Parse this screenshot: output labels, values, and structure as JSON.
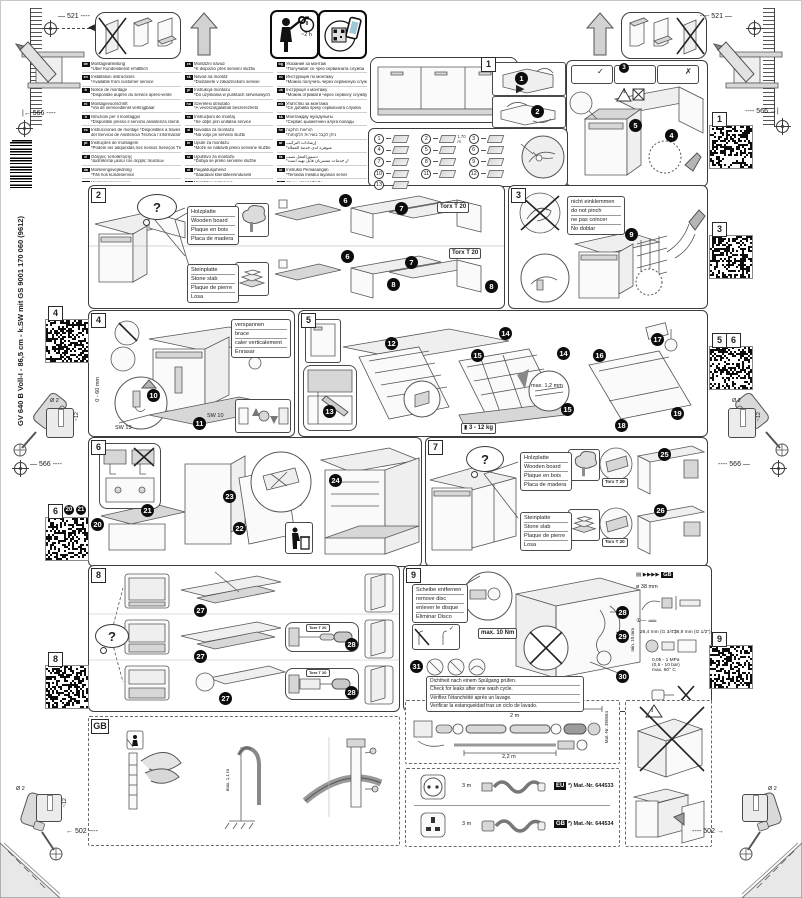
{
  "page": {
    "side_text": "GV 640 B  Voll-I - 86,5 cm - k.SW mit GS    9001 170 060 (9612)"
  },
  "icons": {
    "question": "?",
    "check": "✓",
    "cross": "✗",
    "play_right": "▶",
    "play_left": "◀",
    "warning": "!"
  },
  "dims": {
    "top": "521",
    "mid": "566",
    "bottom": "502",
    "drill_diameter": "Ø 2",
    "drill_depth": "~12"
  },
  "top_icons": {
    "time_estimate": "~2 h"
  },
  "steps": {
    "s1": "1",
    "s2": "2",
    "s3": "3",
    "s4": "4",
    "s5": "5",
    "s6": "6",
    "s7": "7",
    "s8": "8",
    "s9": "9",
    "gb": "GB"
  },
  "badges": {
    "s1": [
      "1",
      "2",
      "3",
      "4",
      "5"
    ],
    "s2": [
      "6",
      "7",
      "6",
      "7",
      "8",
      "8"
    ],
    "s3": [
      "9"
    ],
    "s4": [
      "10",
      "11"
    ],
    "s5": [
      "12",
      "13",
      "14",
      "14",
      "15",
      "15",
      "16",
      "17",
      "18",
      "19"
    ],
    "s6": [
      "20",
      "21",
      "22",
      "23",
      "24"
    ],
    "s7": [
      "25",
      "26"
    ],
    "s8": [
      "27",
      "27",
      "27",
      "28",
      "28"
    ],
    "s9": [
      "28",
      "29",
      "30",
      "31"
    ],
    "qr6": [
      "20",
      "21"
    ]
  },
  "qr": {
    "left": [
      "4",
      "6",
      "8"
    ],
    "right": [
      "1",
      "3",
      "5",
      "6",
      "9"
    ]
  },
  "notes": {
    "wood": [
      "Holzplatte",
      "Wooden board",
      "Plaque en bois",
      "Placa de madera"
    ],
    "stone": [
      "Steinplatte",
      "Stone slab",
      "Plaque de pierre",
      "Losa"
    ],
    "pinch": [
      "nicht einklemmen",
      "do not pinch",
      "ne pas coincer",
      "No doblar"
    ],
    "brace": [
      "verspannen",
      "brace",
      "caler verticalement",
      "Enrasar"
    ],
    "disc": [
      "Scheibe entfernen",
      "remove disc",
      "enlever le disque",
      "Eliminar Disco"
    ],
    "leak": [
      "Dichtheit nach einem Spülgang prüfen.",
      "Check for leaks after one wash cycle.",
      "Vérifiez l'étanchéité après un lavage.",
      "Verificar la estanqueidad tras un ciclo de lavado."
    ]
  },
  "labels": {
    "torx": "Torx T 20",
    "sw13": "SW 13",
    "sw10": "SW 10",
    "range060": "0 - 60 mm",
    "gap": "max. 1,2 mm",
    "weight": "3 - 12 kg",
    "torque": "max. 10 Nm",
    "dia38": "ø 38 mm",
    "min10": "min. 10 mm",
    "g34": "26,4 mm (G 3/4\")",
    "g12": "28,9 mm (G 1/2\")",
    "pressure": "0,05 - 1 MPa",
    "pressure2": "(0,5 - 10 bar)",
    "temp": "max. 60° C",
    "gb": "GB",
    "hose_total": "max. 7,0",
    "hose_len1": "2 m",
    "hose_len2": "2,2 m",
    "mat_hose": "Mat.-Nr. 350564",
    "hose_high": "max. 1,1 m",
    "hose170": "1,70 m"
  },
  "plugs": [
    {
      "length": "3 m",
      "region": "EU",
      "mat": "*) Mat.-Nr. 644533"
    },
    {
      "length": "3 m",
      "region": "GB",
      "mat": "*) Mat.-Nr. 644534"
    }
  ],
  "parts": [
    {
      "n": "1",
      "name": "sealing-strip"
    },
    {
      "n": "2",
      "name": "drain-hose",
      "label": "1,70 m"
    },
    {
      "n": "3",
      "name": "mounting-template"
    },
    {
      "n": "4",
      "name": "fixing-clips"
    },
    {
      "n": "5",
      "name": "base-cover"
    },
    {
      "n": "6",
      "name": "screws-short"
    },
    {
      "n": "7",
      "name": "brackets"
    },
    {
      "n": "8",
      "name": "protection-plates"
    },
    {
      "n": "9",
      "name": "screws-long"
    },
    {
      "n": "10",
      "name": "angle-brackets"
    },
    {
      "n": "11",
      "name": "cap"
    },
    {
      "n": "12",
      "name": "countersunk-screws"
    },
    {
      "n": "13",
      "name": "spacer-wedges"
    }
  ],
  "languages": {
    "col1": [
      {
        "code": "de",
        "lines": [
          "Montageanleitung",
          "*Über Kundendienst erhältlich"
        ]
      },
      {
        "code": "en",
        "lines": [
          "Installation instructions",
          "*Available from customer service"
        ]
      },
      {
        "code": "fr",
        "lines": [
          "Notice de montage",
          "*Disponible auprès du service après-vente"
        ]
      },
      {
        "code": "nl",
        "lines": [
          "Montagevoorschrift",
          "*Via de servicedienst verkrijgbaar"
        ]
      },
      {
        "code": "it",
        "lines": [
          "Istruzioni per il montaggio",
          "*Disponibili presso il servizio assistenza clienti"
        ]
      },
      {
        "code": "es",
        "lines": [
          "Instrucciones de montaje  *Disponibles a través",
          "del Servicio de Asistencia Técnica / información"
        ]
      },
      {
        "code": "pt",
        "lines": [
          "Instruções de montagem",
          "*Podem ser adquiridas nos nossos Serviços Técnicos"
        ]
      },
      {
        "code": "el",
        "lines": [
          "Οδηγίες τοποθέτησης",
          "*Διατίθενται μέσω του σέρβις πελατών"
        ]
      },
      {
        "code": "da",
        "lines": [
          "Monteringsvejledning",
          "*Fås hos kundeservice"
        ]
      },
      {
        "code": "sv",
        "lines": [
          "Monteringsanvisning",
          "*Fås hos kundtjänst"
        ]
      },
      {
        "code": "no",
        "lines": [
          "Monteringsveiledning",
          "*Kan fås hos kundeservice/serviceavdelingen"
        ]
      },
      {
        "code": "fi",
        "lines": [
          "Asennusohje",
          "*Saatavana huoltopalvelusta"
        ]
      }
    ],
    "col2": [
      {
        "code": "cs",
        "lines": [
          "Montážní návod",
          "*K dispozici přes servisní službu"
        ]
      },
      {
        "code": "sk",
        "lines": [
          "Návod na montáž",
          "*Dostanete v zákazníckom servise"
        ]
      },
      {
        "code": "pl",
        "lines": [
          "Instrukcja montażu",
          "*Do uzyskania w punktach serwisowych"
        ]
      },
      {
        "code": "hu",
        "lines": [
          "Szerelési útmutató",
          "*A vevőszolgálatnál beszerezhető"
        ]
      },
      {
        "code": "ro",
        "lines": [
          "Instrucţiuni de montaj",
          "*Se obţin prin unitatea service"
        ]
      },
      {
        "code": "sl",
        "lines": [
          "Navodila za montažo",
          "*Na voljo pri servisni službi"
        ]
      },
      {
        "code": "hr",
        "lines": [
          "Upute za montažu",
          "*Može se nabaviti preko servisne službe"
        ]
      },
      {
        "code": "sr",
        "lines": [
          "Uputstvo za montažu",
          "*Dobija se preko servisne službe"
        ]
      },
      {
        "code": "et",
        "lines": [
          "Paigaldusjuhend",
          "*Saadaval klienditeenindusest"
        ]
      },
      {
        "code": "lv",
        "lines": [
          "Montāžas instrukcija",
          "*Saņemama klientu servisā"
        ]
      },
      {
        "code": "lt",
        "lines": [
          "Montavimo instrukcija",
          "*Galima įsigyti klientų aptarnavimo tarnyboje"
        ]
      },
      {
        "code": "tr",
        "lines": [
          "Montaj kılavuzu",
          "*Yetkili servisten temin edilebilir"
        ]
      },
      {
        "code": "az",
        "lines": [
          "Quraşdırma təlimatı",
          "*Xidmət mərkəzindən əldə edilə bilər"
        ]
      },
      {
        "code": "ka",
        "lines": [
          "Montaj instruksiyasi",
          "*Servis xidmətindən"
        ]
      }
    ],
    "col3": [
      {
        "code": "bg",
        "lines": [
          "Указания за монтаж",
          "*Получават се чрез сервизната служба"
        ]
      },
      {
        "code": "ru",
        "lines": [
          "Инструкция по монтажу",
          "*Можно получить через сервисную службу"
        ]
      },
      {
        "code": "uk",
        "lines": [
          "Інструкція з монтажу",
          "*Можна отримати через сервісну службу"
        ]
      },
      {
        "code": "mk",
        "lines": [
          "Упатство за монтажа",
          "*Се добива преку сервисната служба"
        ]
      },
      {
        "code": "kk",
        "lines": [
          "Монтаждау нұсқаулығы",
          "*Сервис қызметінен алуға болады"
        ]
      },
      {
        "code": "he",
        "lines": [
          "הוראות התקנה",
          "*ניתן לקבל בשירות הלקוחות"
        ]
      },
      {
        "code": "ar",
        "lines": [
          "إرشادات التركيب",
          "*متوفرة لدى خدمة العملاء"
        ]
      },
      {
        "code": "fa",
        "lines": [
          "دستورالعمل نصب",
          "*از خدمات مشتریان قابل تهیه است"
        ]
      },
      {
        "code": "id",
        "lines": [
          "Instruksi Pemasangan",
          "*Tersedia melalui layanan servis"
        ]
      },
      {
        "code": "th",
        "lines": [
          "คำแนะนำการติดตั้ง",
          "*ขอรับได้จากศูนย์บริการ"
        ]
      },
      {
        "code": "ko",
        "lines": [
          "설치 안내서",
          "*서비스 센터에서 구입 가능"
        ]
      },
      {
        "code": "zh",
        "lines": [
          "安装说明",
          "*可向客户服务中心索取"
        ]
      },
      {
        "code": "tw",
        "lines": [
          "安裝說明",
          "*可向客戶服務中心索取"
        ]
      }
    ]
  }
}
